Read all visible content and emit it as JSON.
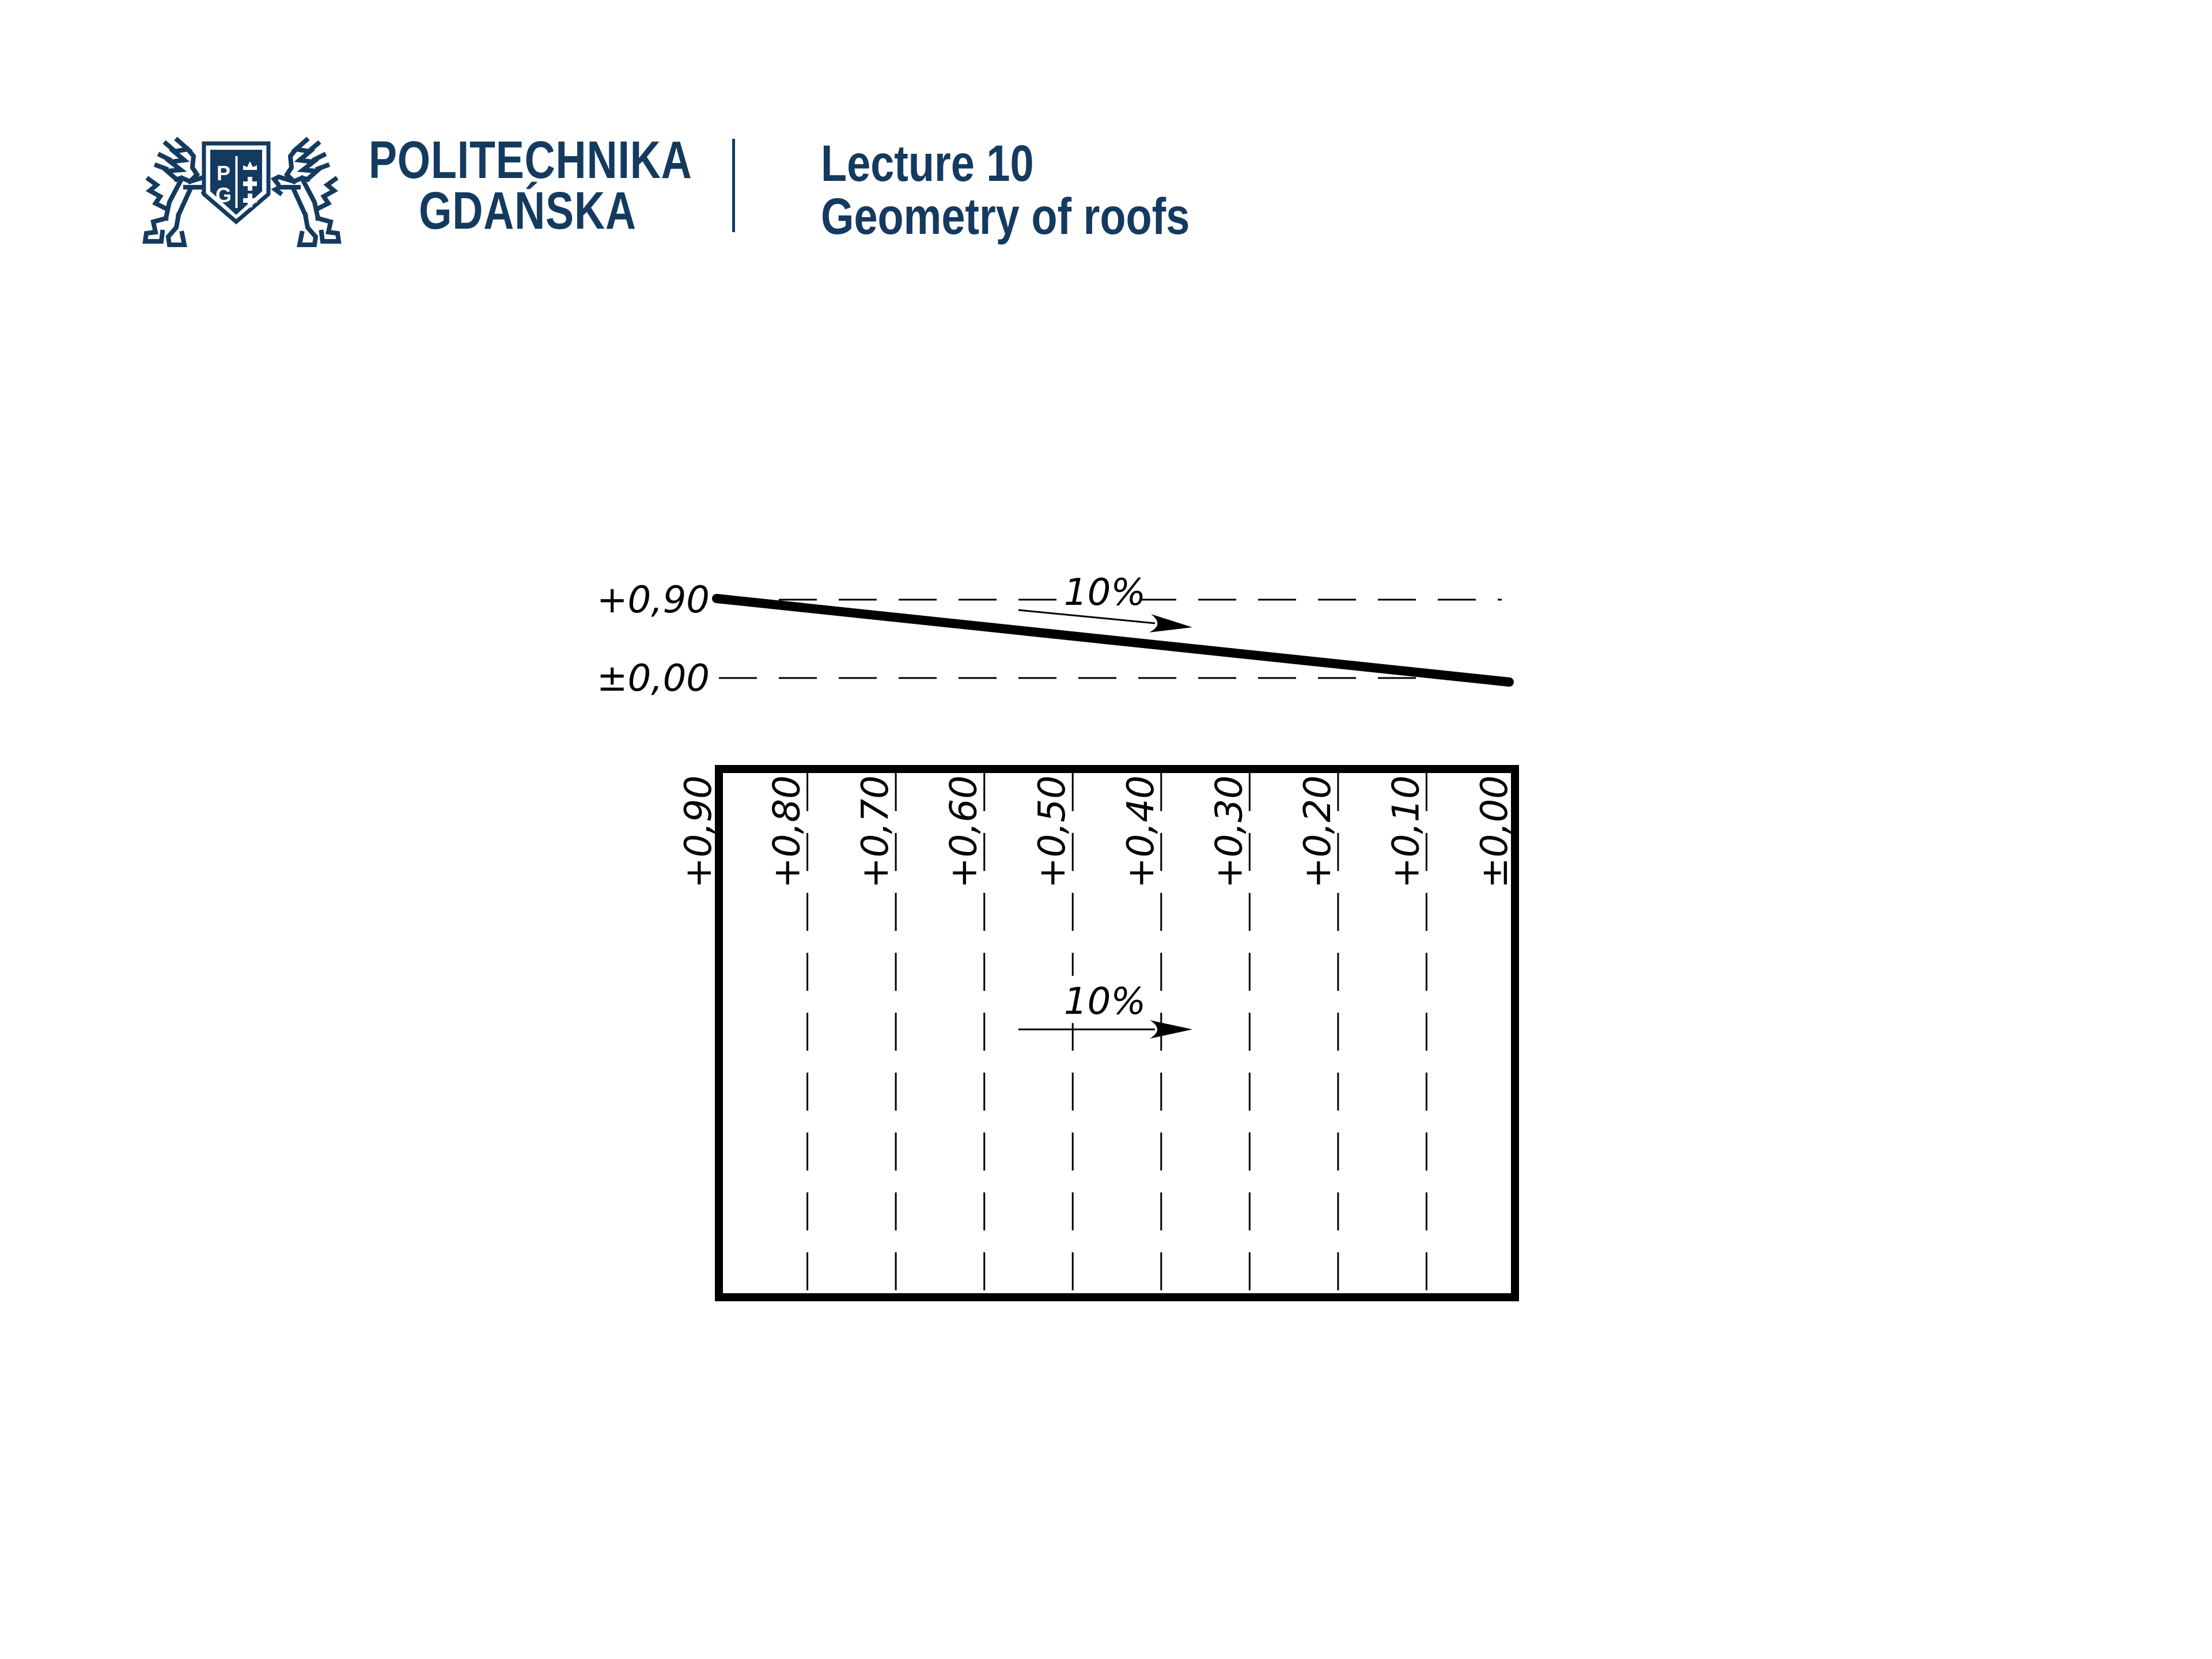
{
  "header": {
    "brand_color": "#143a5f",
    "logo": {
      "name": "Politechnika Gdańska coat of arms",
      "letter_top": "P",
      "letter_bottom": "G"
    },
    "university_name_line1": "POLITECHNIKA",
    "university_name_line2": "GDAŃSKA",
    "lecture_number": "Lecture 10",
    "lecture_title": "Geometry of roofs"
  },
  "drawing": {
    "line_color": "#000000",
    "section": {
      "upper_level_label": "+0,90",
      "lower_level_label": "±0,00",
      "slope_label": "10%"
    },
    "plan": {
      "slope_label": "10%",
      "contour_labels": [
        "+0,90",
        "+0,80",
        "+0,70",
        "+0,60",
        "+0,50",
        "+0,40",
        "+0,30",
        "+0,20",
        "+0,10",
        "±0,00"
      ]
    }
  }
}
